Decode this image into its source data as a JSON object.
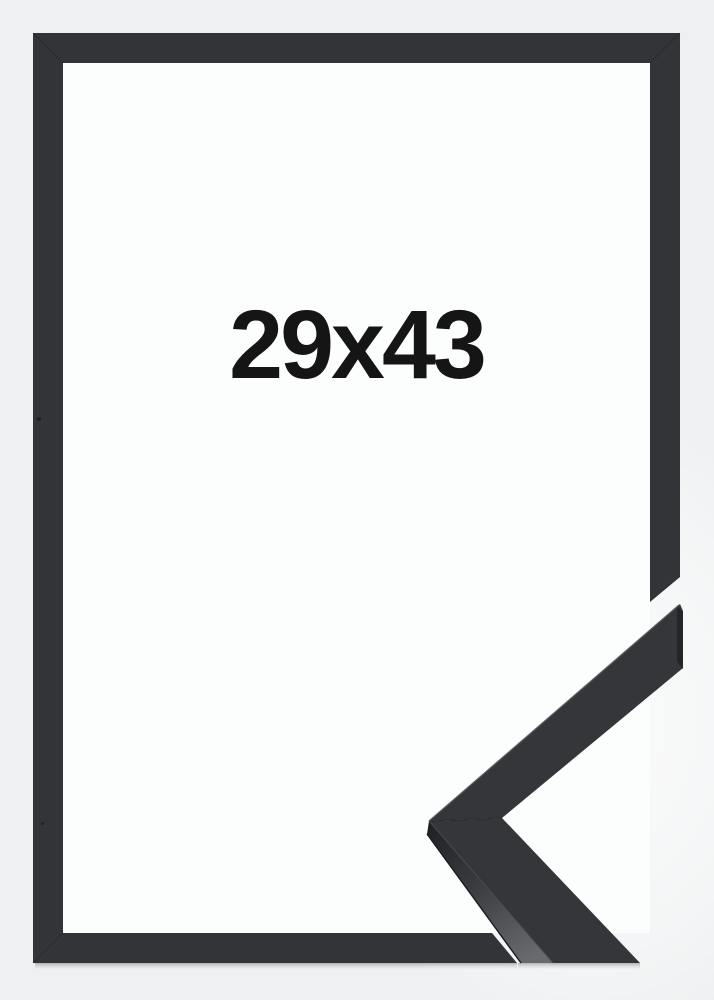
{
  "product": {
    "size_label": "29x43",
    "colors": {
      "page_background": "#eef0f1",
      "inner_panel": "#fcfdfd",
      "frame": "#323437",
      "sample_top_surface": "#35363a",
      "sample_end_face": "#232529",
      "label_text": "#151515"
    }
  }
}
